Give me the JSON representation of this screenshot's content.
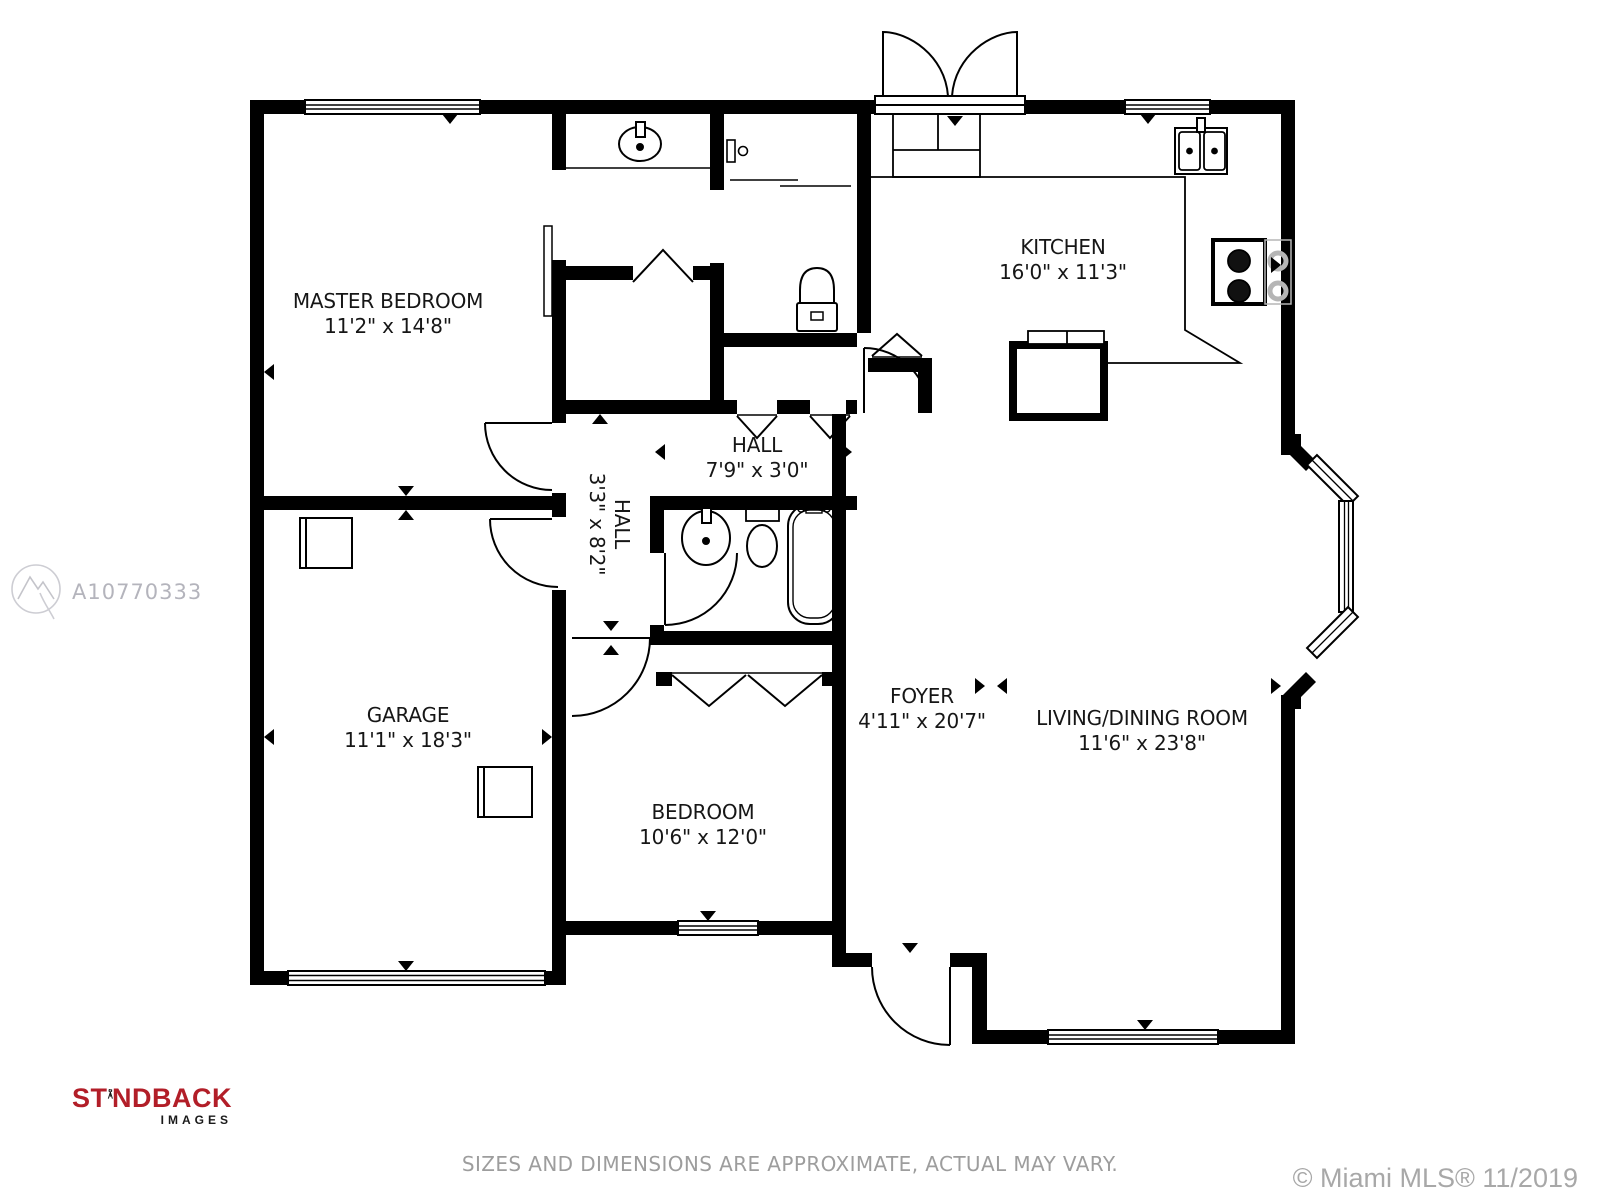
{
  "rooms": {
    "master_bedroom": {
      "name": "MASTER BEDROOM",
      "dims": "11'2\" x 14'8\""
    },
    "kitchen": {
      "name": "KITCHEN",
      "dims": "16'0\" x 11'3\""
    },
    "hall": {
      "name": "HALL",
      "dims": "7'9\" x 3'0\""
    },
    "hall2": {
      "name": "HALL",
      "dims": "3'3\" x 8'2\""
    },
    "garage": {
      "name": "GARAGE",
      "dims": "11'1\" x 18'3\""
    },
    "bedroom": {
      "name": "BEDROOM",
      "dims": "10'6\" x 12'0\""
    },
    "foyer": {
      "name": "FOYER",
      "dims": "4'11\" x 20'7\""
    },
    "living_dining": {
      "name": "LIVING/DINING ROOM",
      "dims": "11'6\" x 23'8\""
    }
  },
  "watermark": {
    "id": "A10770333"
  },
  "logo": {
    "brand_left": "ST",
    "brand_right": "NDBACK",
    "sub": "IMAGES"
  },
  "footer": {
    "disclaimer": "SIZES AND DIMENSIONS ARE APPROXIMATE, ACTUAL MAY VARY.",
    "copyright": "© Miami MLS® 11/2019"
  },
  "colors": {
    "wall": "#000000",
    "label_text": "#161616",
    "watermark_gray": "#b4b4bc",
    "logo_red": "#b21e28",
    "footer_gray": "#9d9d9d",
    "burner_gray": "#b5b5b5"
  }
}
